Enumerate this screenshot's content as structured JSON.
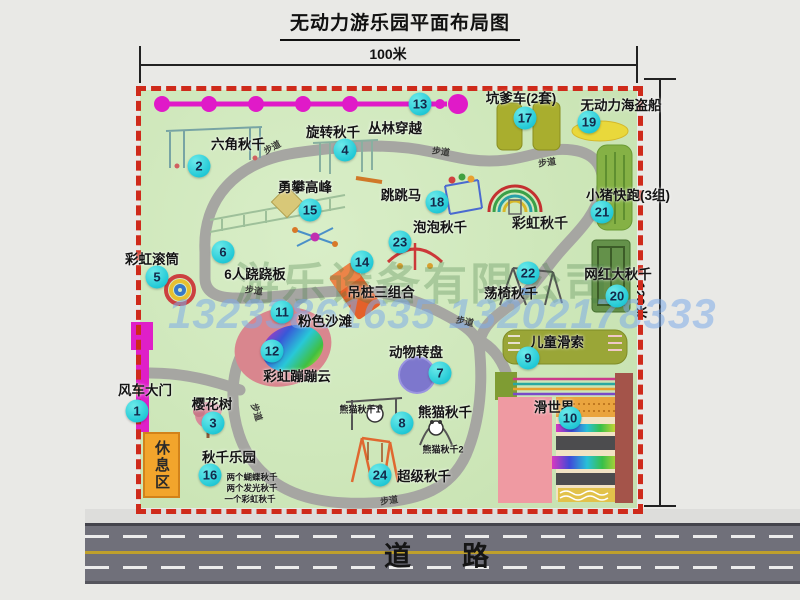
{
  "title": "无动力游乐园平面布局图",
  "dimensions": {
    "top": "100米",
    "right": "120米"
  },
  "road_label": "道　路",
  "watermark": {
    "company": "游乐设备有限公司",
    "phone": "13233861635 13202178333"
  },
  "rest_area_label": "休息区",
  "colors": {
    "marker": "#22c9d6",
    "border_dash": "#cf2a1b",
    "zipline": "#e01ac8",
    "gate": "#df1fc8",
    "rest_area": "#f2a52c",
    "park_green": "#cbe5b6",
    "road": "#70707a",
    "slide_pink": "#ef9aa2",
    "zone_olive": "#a9ae2e"
  },
  "attractions": [
    {
      "num": "1",
      "label": "风车大门",
      "lx": 145,
      "ly": 389,
      "mx": 137,
      "my": 411
    },
    {
      "num": "2",
      "label": "六角秋千",
      "lx": 238,
      "ly": 143,
      "mx": 199,
      "my": 166
    },
    {
      "num": "3",
      "label": "樱花树",
      "lx": 212,
      "ly": 403,
      "mx": 213,
      "my": 423
    },
    {
      "num": "4",
      "label": "旋转秋千",
      "lx": 333,
      "ly": 131,
      "mx": 345,
      "my": 150
    },
    {
      "num": "5",
      "label": "彩虹滚筒",
      "lx": 152,
      "ly": 258,
      "mx": 157,
      "my": 277
    },
    {
      "num": "6",
      "label": "6人跷跷板",
      "lx": 255,
      "ly": 273,
      "mx": 223,
      "my": 252
    },
    {
      "num": "7",
      "label": "动物转盘",
      "lx": 416,
      "ly": 351,
      "mx": 440,
      "my": 373
    },
    {
      "num": "8",
      "label": "熊猫秋千",
      "lx": 445,
      "ly": 411,
      "mx": 402,
      "my": 423
    },
    {
      "num": "9",
      "label": "儿童滑索",
      "lx": 557,
      "ly": 341,
      "mx": 528,
      "my": 358
    },
    {
      "num": "10",
      "label": "滑世界",
      "lx": 554,
      "ly": 406,
      "mx": 570,
      "my": 418
    },
    {
      "num": "11",
      "label": "粉色沙滩",
      "lx": 325,
      "ly": 320,
      "mx": 282,
      "my": 312
    },
    {
      "num": "12",
      "label": "彩虹蹦蹦云",
      "lx": 297,
      "ly": 375,
      "mx": 272,
      "my": 351
    },
    {
      "num": "13",
      "label": "丛林穿越",
      "lx": 395,
      "ly": 127,
      "mx": 420,
      "my": 104
    },
    {
      "num": "14",
      "label": "吊桩三组合",
      "lx": 381,
      "ly": 291,
      "mx": 362,
      "my": 262
    },
    {
      "num": "15",
      "label": "勇攀高峰",
      "lx": 305,
      "ly": 186,
      "mx": 310,
      "my": 210
    },
    {
      "num": "16",
      "label": "秋千乐园",
      "lx": 229,
      "ly": 456,
      "mx": 210,
      "my": 475
    },
    {
      "num": "17",
      "label": "坑爹车(2套)",
      "lx": 521,
      "ly": 97,
      "mx": 525,
      "my": 118
    },
    {
      "num": "18",
      "label": "跳跳马",
      "lx": 401,
      "ly": 194,
      "mx": 437,
      "my": 202
    },
    {
      "num": "19",
      "label": "无动力海盗船",
      "lx": 621,
      "ly": 104,
      "mx": 589,
      "my": 122
    },
    {
      "num": "20",
      "label": "网红大秋千",
      "lx": 618,
      "ly": 273,
      "mx": 617,
      "my": 296
    },
    {
      "num": "21",
      "label": "小猪快跑(3组)",
      "lx": 628,
      "ly": 194,
      "mx": 602,
      "my": 212
    },
    {
      "num": "22",
      "label": "荡椅秋千",
      "lx": 511,
      "ly": 292,
      "mx": 528,
      "my": 273
    },
    {
      "num": "23",
      "label": "泡泡秋千",
      "lx": 440,
      "ly": 226,
      "mx": 400,
      "my": 242
    },
    {
      "num": "24",
      "label": "超级秋千",
      "lx": 424,
      "ly": 475,
      "mx": 380,
      "my": 475
    }
  ],
  "sub_labels": [
    {
      "text": "彩虹秋千",
      "x": 540,
      "y": 223,
      "size": 14
    },
    {
      "text": "熊猫秋千1",
      "x": 360,
      "y": 409,
      "size": 9
    },
    {
      "text": "熊猫秋千2",
      "x": 443,
      "y": 449,
      "size": 9
    },
    {
      "text": "两个蝴蝶秋千",
      "x": 252,
      "y": 477,
      "size": 8.5
    },
    {
      "text": "两个发光秋千",
      "x": 252,
      "y": 488,
      "size": 8.5
    },
    {
      "text": "一个彩虹秋千",
      "x": 250,
      "y": 499,
      "size": 8.5
    }
  ],
  "path_labels": [
    {
      "text": "步道",
      "x": 272,
      "y": 147,
      "r": -28
    },
    {
      "text": "步道",
      "x": 441,
      "y": 151,
      "r": 8
    },
    {
      "text": "步道",
      "x": 547,
      "y": 162,
      "r": -8
    },
    {
      "text": "步道",
      "x": 254,
      "y": 290,
      "r": 8
    },
    {
      "text": "步道",
      "x": 465,
      "y": 321,
      "r": 12
    },
    {
      "text": "步道",
      "x": 257,
      "y": 412,
      "r": 72
    },
    {
      "text": "步道",
      "x": 389,
      "y": 500,
      "r": -8
    }
  ]
}
